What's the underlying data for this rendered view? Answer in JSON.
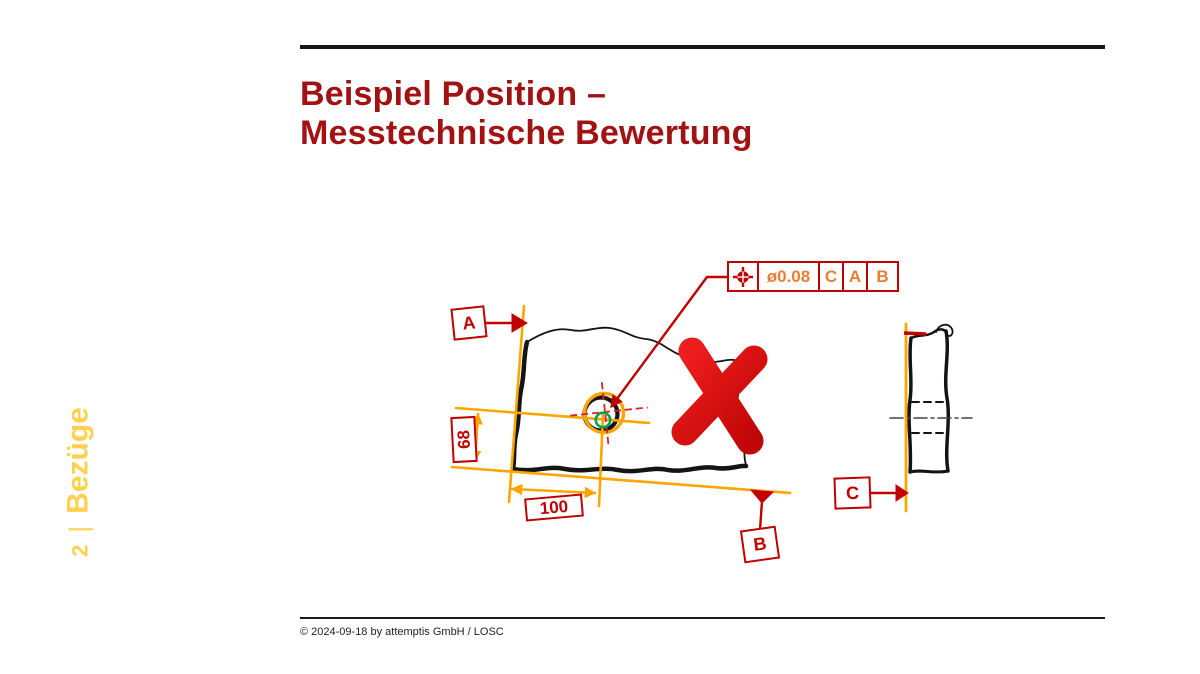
{
  "slide": {
    "title": {
      "line1": "Beispiel Position –",
      "line2": "Messtechnische Bewertung"
    },
    "sidebar": {
      "page_number": "2",
      "separator": "|",
      "section_label": "Bezüge"
    },
    "footer": {
      "copyright": "© 2024-09-18 by attemptis GmbH / LOSC"
    }
  },
  "drawing": {
    "feature_control_frame": {
      "symbol": "position-symbol",
      "tolerance": "ø0.08",
      "datum_primary": "C",
      "datum_secondary": "A",
      "datum_tertiary": "B"
    },
    "datum_labels": {
      "a": "A",
      "b": "B",
      "c": "C"
    },
    "dimensions": {
      "vertical_mm": "68",
      "horizontal_mm": "100"
    },
    "annotations": {
      "tolerance_zone": "orange-circle",
      "actual_hole_position": "green-circle",
      "evaluation": "red-cross-rejected"
    }
  },
  "colors": {
    "title_red": "#A21212",
    "drawing_red": "#C00000",
    "fcf_text_orange": "#ED7D31",
    "dimension_orange": "#FFA500",
    "sidebar_gold": "#FFD14E",
    "actual_green": "#00A44F",
    "cross_red": "#DD1111"
  }
}
